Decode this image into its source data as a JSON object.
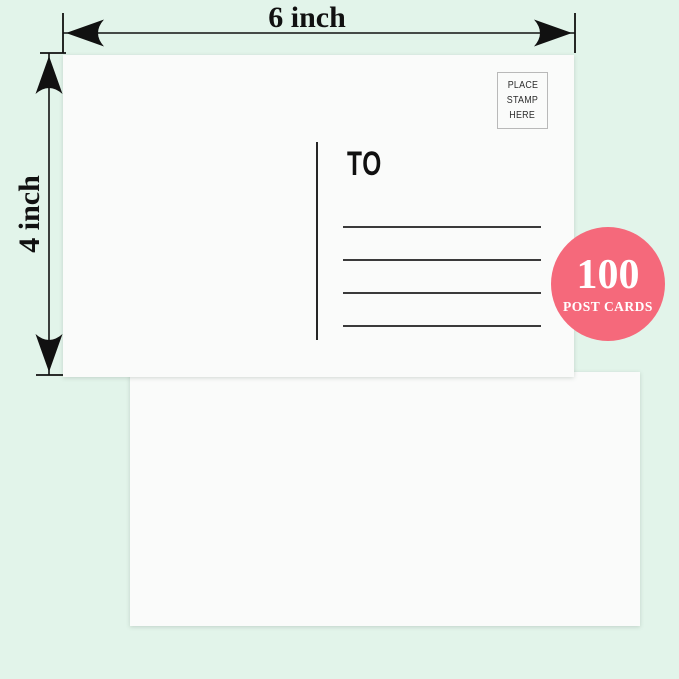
{
  "dimensions": {
    "width_label": "6 inch",
    "height_label": "4 inch"
  },
  "postcard": {
    "to_label": "TO",
    "stamp_box_lines": [
      "PLACE",
      "STAMP",
      "HERE"
    ],
    "address_line_count": 4
  },
  "badge": {
    "count": "100",
    "label": "POST CARDS"
  },
  "colors": {
    "background": "#e2f4ea",
    "card": "#fafbfa",
    "ink": "#1a1a1a",
    "badge_bg": "#f5697b",
    "badge_text": "#ffffff",
    "stamp_border": "#b9b9b9"
  }
}
